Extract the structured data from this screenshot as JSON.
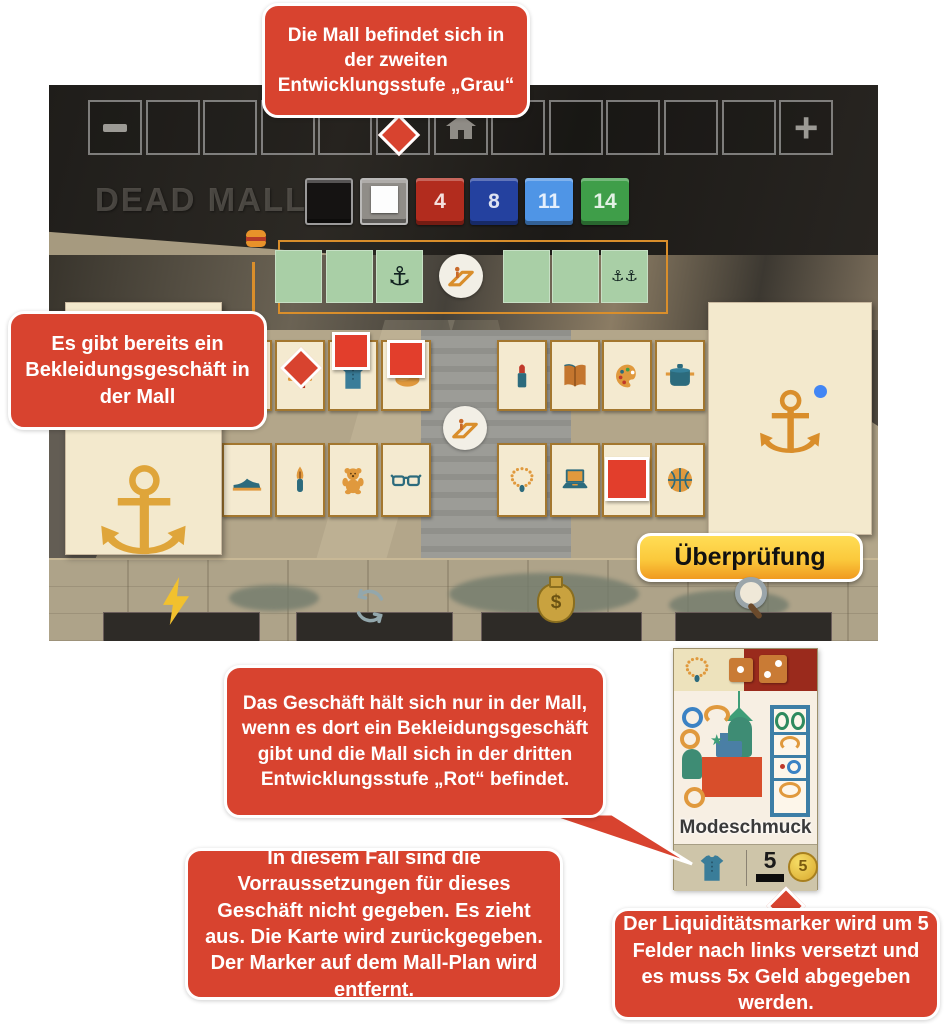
{
  "annotations": {
    "top": "Die Mall befindet sich in der zweiten Entwicklungsstufe „Grau“",
    "left": "Es gibt bereits ein Bekleidungsgeschäft in der Mall",
    "middle": "Das Geschäft hält sich nur in der Mall, wenn es dort ein Bekleidungsgeschäft gibt und die Mall sich in der dritten Entwicklungsstufe „Rot“ befindet.",
    "bottom_left": "In diesem Fall sind die Vorraussetzungen für dieses Geschäft nicht gegeben. Es zieht aus. Die Karte wird zurückgegeben. Der Marker auf dem Mall-Plan wird entfernt.",
    "bottom_right": "Der Liquiditätsmarker wird um 5 Felder nach links versetzt und es muss 5x Geld abgegeben werden."
  },
  "game": {
    "title": "DEAD MALL",
    "toolbar": {
      "square_count": 13,
      "minus_square_index": 0,
      "home_square_index": 6,
      "plus_square_index": 12,
      "plus_label": "+"
    },
    "development_track": [
      {
        "label": "",
        "color": "#151312",
        "variant": "black-marble"
      },
      {
        "label": "",
        "color": "#908d88",
        "variant": "gray",
        "has_white_marker": true
      },
      {
        "label": "4",
        "color": "#b22c1e"
      },
      {
        "label": "8",
        "color": "#24419f"
      },
      {
        "label": "11",
        "color": "#4f95e6"
      },
      {
        "label": "14",
        "color": "#3f9e49"
      }
    ],
    "mall_plan": {
      "anchor_glyph": "⚓",
      "left_row": [
        {
          "anchors": 0
        },
        {
          "anchors": 0
        },
        {
          "anchors": 1
        }
      ],
      "right_row": [
        {
          "anchors": 0
        },
        {
          "anchors": 0
        },
        {
          "anchors": 2
        }
      ]
    },
    "shop_cards": {
      "top_left": [
        {
          "icon": ""
        },
        {
          "icon": "hat"
        },
        {
          "icon": "shirt",
          "marker": {
            "size": 38,
            "dx": 2,
            "dy": -10
          }
        },
        {
          "icon": "bread",
          "marker": {
            "size": 38,
            "dx": 4,
            "dy": -2
          }
        }
      ],
      "top_right": [
        {
          "icon": "lipstick"
        },
        {
          "icon": "book"
        },
        {
          "icon": "palette"
        },
        {
          "icon": "pot"
        }
      ],
      "bottom_left": [
        {
          "icon": "shoe"
        },
        {
          "icon": "pen"
        },
        {
          "icon": "teddy-bear"
        },
        {
          "icon": "glasses"
        }
      ],
      "bottom_right": [
        {
          "icon": "necklace"
        },
        {
          "icon": "laptop"
        },
        {
          "icon": "",
          "marker": {
            "size": 44,
            "dx": 1,
            "dy": 12
          }
        },
        {
          "icon": "basketball"
        }
      ]
    },
    "anchor_stores": {
      "left": {
        "anchor_glyph": "⚓"
      },
      "right": {
        "anchor_glyph": "⚓",
        "blue_dot": true
      }
    },
    "button_label": "Überprüfung",
    "action_bar": [
      "lightning",
      "cycle",
      "money-bag",
      "magnifier"
    ],
    "money_symbol": "$"
  },
  "shop_detail_card": {
    "title": "Modeschmuck",
    "header_icons": [
      "necklace",
      "die-1",
      "die-2"
    ],
    "requirement_icon": "shirt",
    "liquidity_value": "5",
    "coin_value": "5"
  },
  "colors": {
    "annotation_red": "#d8432f",
    "plan_green": "#a9cfa6",
    "plan_outline_orange": "#d98e2b",
    "card_cream": "#f4ead0",
    "marker_red": "#e23e2c",
    "button_yellow_top": "#ffdd55",
    "button_orange_bottom": "#f09a20",
    "detail_header_red": "#9a2a1c",
    "coin_gold": "#d9a92f"
  }
}
